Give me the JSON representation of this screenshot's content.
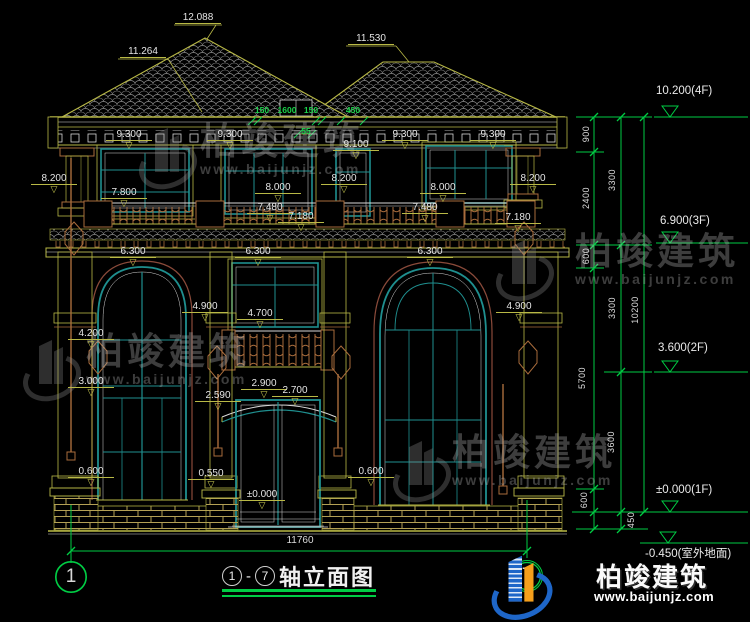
{
  "drawing": {
    "title_axis_from": "1",
    "title_axis_to": "7",
    "title_text": "轴立面图",
    "axis_bubbles": [
      "1",
      "7"
    ],
    "bottom_dim": "11760",
    "elevation_labels": [
      {
        "t": "12.088",
        "x": 198,
        "y": 12,
        "cls": "lead"
      },
      {
        "t": "11.264",
        "x": 143,
        "y": 46,
        "cls": "lead"
      },
      {
        "t": "11.530",
        "x": 371,
        "y": 33,
        "cls": "lead"
      },
      {
        "t": "9.300",
        "x": 129,
        "y": 129
      },
      {
        "t": "9.300",
        "x": 230,
        "y": 129
      },
      {
        "t": "9.300",
        "x": 405,
        "y": 129
      },
      {
        "t": "9.300",
        "x": 493,
        "y": 129
      },
      {
        "t": "9.100",
        "x": 356,
        "y": 139
      },
      {
        "t": "8.200",
        "x": 54,
        "y": 173
      },
      {
        "t": "8.200",
        "x": 344,
        "y": 173
      },
      {
        "t": "8.200",
        "x": 533,
        "y": 173
      },
      {
        "t": "8.000",
        "x": 278,
        "y": 182
      },
      {
        "t": "8.000",
        "x": 443,
        "y": 182
      },
      {
        "t": "7.800",
        "x": 124,
        "y": 187
      },
      {
        "t": "7.480",
        "x": 270,
        "y": 202
      },
      {
        "t": "7.480",
        "x": 425,
        "y": 202
      },
      {
        "t": "7.180",
        "x": 301,
        "y": 211
      },
      {
        "t": "7.180",
        "x": 518,
        "y": 212
      },
      {
        "t": "6.300",
        "x": 133,
        "y": 246
      },
      {
        "t": "6.300",
        "x": 258,
        "y": 246
      },
      {
        "t": "6.300",
        "x": 430,
        "y": 246
      },
      {
        "t": "4.900",
        "x": 205,
        "y": 301
      },
      {
        "t": "4.900",
        "x": 519,
        "y": 301
      },
      {
        "t": "4.700",
        "x": 260,
        "y": 308
      },
      {
        "t": "4.200",
        "x": 91,
        "y": 328
      },
      {
        "t": "3.000",
        "x": 91,
        "y": 376
      },
      {
        "t": "2.900",
        "x": 264,
        "y": 378
      },
      {
        "t": "2.700",
        "x": 295,
        "y": 385
      },
      {
        "t": "2.590",
        "x": 218,
        "y": 390
      },
      {
        "t": "0.600",
        "x": 91,
        "y": 466
      },
      {
        "t": "0.550",
        "x": 211,
        "y": 468
      },
      {
        "t": "0.600",
        "x": 371,
        "y": 466
      },
      {
        "t": "±0.000",
        "x": 262,
        "y": 489
      }
    ],
    "green_dims": [
      {
        "t": "150",
        "x": 262,
        "y": 105
      },
      {
        "t": "1600",
        "x": 287,
        "y": 105
      },
      {
        "t": "150",
        "x": 311,
        "y": 105
      },
      {
        "t": "450",
        "x": 353,
        "y": 105
      },
      {
        "t": "55",
        "x": 306,
        "y": 126
      }
    ],
    "chain_labels": [
      {
        "t": "900",
        "x": 586,
        "y": 134
      },
      {
        "t": "2400",
        "x": 586,
        "y": 198
      },
      {
        "t": "600",
        "x": 586,
        "y": 256
      },
      {
        "t": "5700",
        "x": 582,
        "y": 378
      },
      {
        "t": "600",
        "x": 584,
        "y": 500
      },
      {
        "t": "3300",
        "x": 612,
        "y": 180
      },
      {
        "t": "3300",
        "x": 612,
        "y": 308
      },
      {
        "t": "3600",
        "x": 611,
        "y": 442
      },
      {
        "t": "450",
        "x": 631,
        "y": 520
      },
      {
        "t": "10200",
        "x": 635,
        "y": 310
      }
    ],
    "level_flags": [
      {
        "t": "10.200(4F)",
        "x": 656,
        "y": 85
      },
      {
        "t": "6.900(3F)",
        "x": 660,
        "y": 215
      },
      {
        "t": "3.600(2F)",
        "x": 658,
        "y": 342
      },
      {
        "t": "±0.000(1F)",
        "x": 656,
        "y": 484
      },
      {
        "t": "-0.450(室外地面)",
        "x": 645,
        "y": 545
      }
    ]
  },
  "icons": {
    "level_marker": "▽"
  },
  "brand": {
    "name": "柏竣建筑",
    "url": "www.baijunjz.com"
  },
  "colors": {
    "line_yellow": "#b9b946",
    "line_white": "#d9d9d9",
    "window_teal": "#1f8f8f",
    "wood_brown": "#a96c3c",
    "dim_green": "#00cc44",
    "logo_blue": "#1e66c8",
    "logo_orange": "#f59f1b"
  }
}
